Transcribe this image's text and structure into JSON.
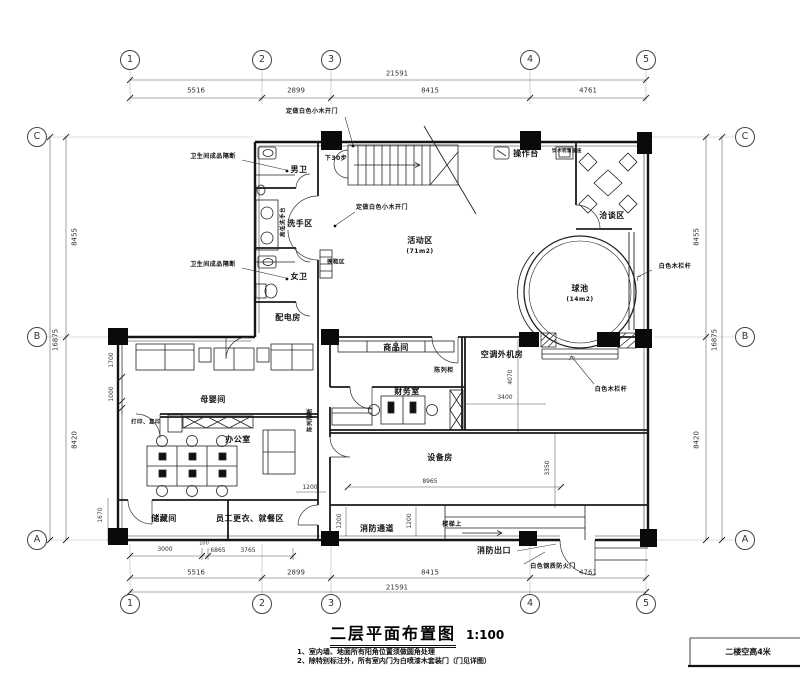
{
  "title": {
    "text": "二层平面布置图",
    "scale": "1:100"
  },
  "notes": [
    "1、室内墙、地面所有阳角位置须做圆角处理",
    "2、除特别标注外，所有室内门为白喷漆木套装门（门见详图）"
  ],
  "title_block": {
    "text": "二楼空高4米"
  },
  "grid": {
    "cols": [
      "1",
      "2",
      "3",
      "4",
      "5"
    ],
    "rows": [
      "C",
      "B",
      "A"
    ]
  },
  "dims": {
    "top_total": "21591",
    "top": [
      "5516",
      "2899",
      "8415",
      "4761"
    ],
    "bottom_total": "21591",
    "bottom_inner": [
      "3000",
      "100",
      "6865",
      "3765"
    ],
    "left": [
      "8455",
      "8420"
    ],
    "left_total": "16875",
    "right": [
      "8455",
      "8420"
    ],
    "right_total": "16875",
    "interior": {
      "d1700": "1700",
      "d1000": "1000",
      "d1670": "1670",
      "d1200": "1200",
      "d8965": "8965",
      "d3350": "3350",
      "d4070": "4070",
      "d3400": "3400"
    }
  },
  "rooms": {
    "male_wc": "男卫",
    "wash": "洗手区",
    "female_wc": "女卫",
    "power": "配电房",
    "activity": "活动区",
    "activity_area": "(71m2)",
    "meeting": "洽谈区",
    "ballpool": "球池",
    "ballpool_area": "(14m2)",
    "goods": "商品间",
    "ac": "空调外机房",
    "display_cabinet": "陈列柜",
    "finance": "财务室",
    "nursing": "母婴间",
    "office": "办公室",
    "storage": "储藏间",
    "staff": "员工更衣、就餐区",
    "equipment": "设备房",
    "fire_passage": "消防通道",
    "fire_exit": "消防出口",
    "counter": "操作台"
  },
  "annotations": {
    "custom_door": "定做白色小木开门",
    "toilet_partition": "卫生间成品隔断",
    "hi_lo_basin": "高低洗手台",
    "water_socket": "饮水机留插座",
    "white_rail": "白色木栏杆",
    "fire_door": "白色钢质防火门",
    "display_partition": "陈列隔断",
    "shoe_area": "换鞋区",
    "print_copy": "打印、复印",
    "down_steps": "下30步",
    "stairs_up": "楼梯上"
  }
}
